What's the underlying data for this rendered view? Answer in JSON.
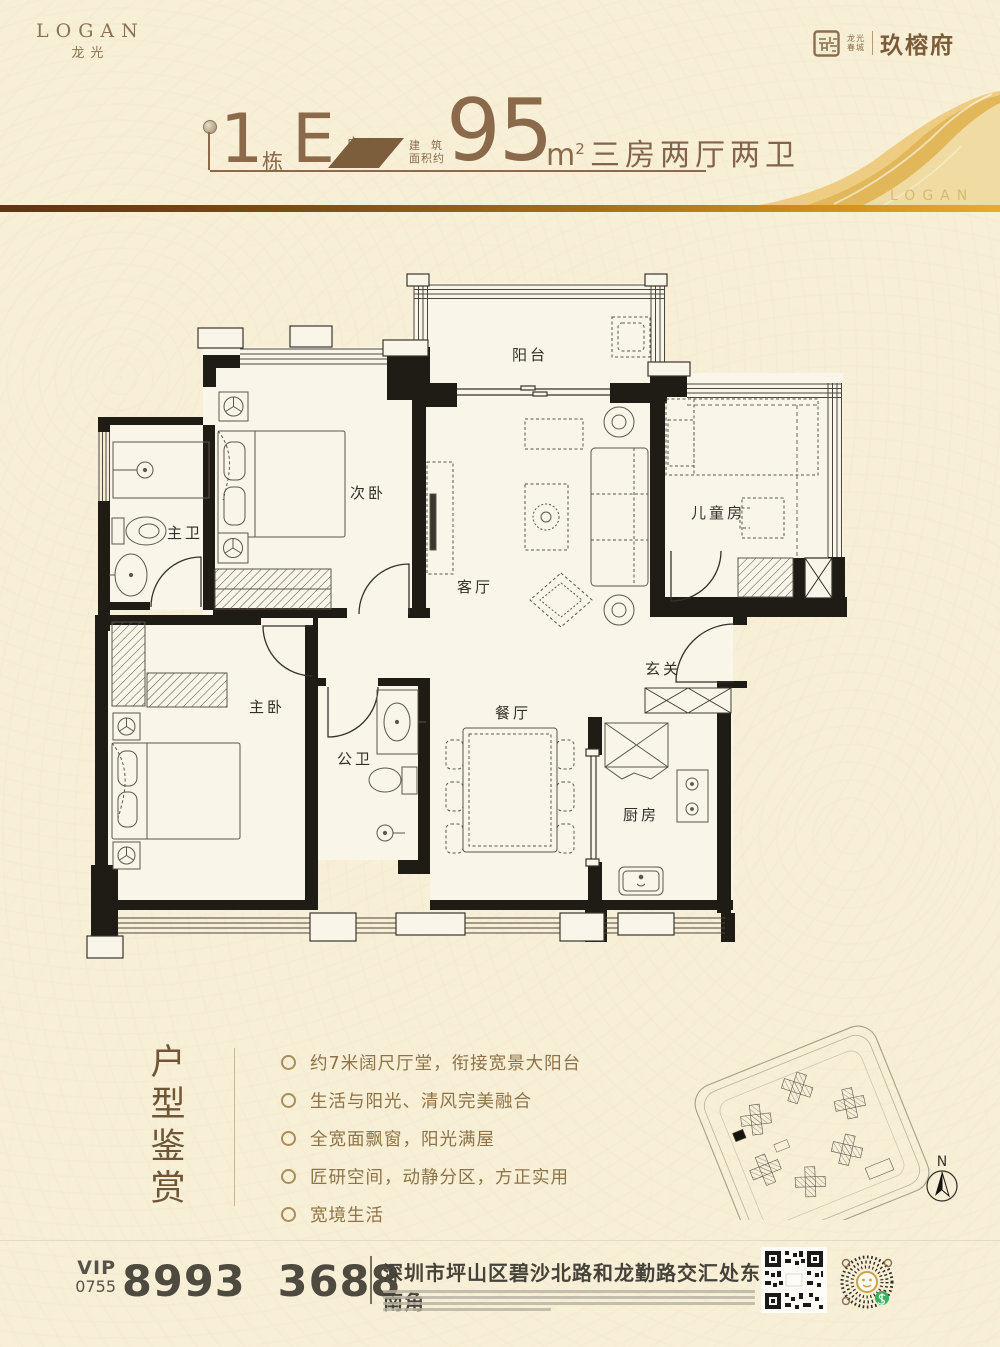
{
  "brand": {
    "logan_en": "LOGAN",
    "logan_cn": "龙光",
    "seal_line1": "龙光",
    "seal_line2": "春城",
    "project_name": "玖榕府",
    "watermark": "LOGAN"
  },
  "header": {
    "block_number": "1",
    "block_unit": "栋",
    "unit_letter": "E",
    "unit_label": "户型",
    "area_label_1": "建筑",
    "area_label_2": "面积约",
    "area_value": "95",
    "area_unit": "m",
    "area_sup": "2",
    "rooms_summary": "三房两厅两卫"
  },
  "floorplan": {
    "rooms": {
      "balcony": "阳台",
      "bedroom2": "次卧",
      "master_bath": "主卫",
      "living": "客厅",
      "kids_room": "儿童房",
      "foyer": "玄关",
      "master_bedroom": "主卧",
      "guest_bath": "公卫",
      "dining": "餐厅",
      "kitchen": "厨房"
    }
  },
  "features": {
    "title": "户型鉴赏",
    "items": [
      "约7米阔尺厅堂，衔接宽景大阳台",
      "生活与阳光、清风完美融合",
      "全宽面飘窗，阳光满屋",
      "匠研空间，动静分区，方正实用",
      "宽境生活"
    ]
  },
  "sitemap": {
    "compass_label": "N"
  },
  "footer": {
    "vip": "VIP",
    "area_code": "0755",
    "phone": "8993 3688",
    "address": "深圳市坪山区碧沙北路和龙勤路交汇处东南角"
  }
}
